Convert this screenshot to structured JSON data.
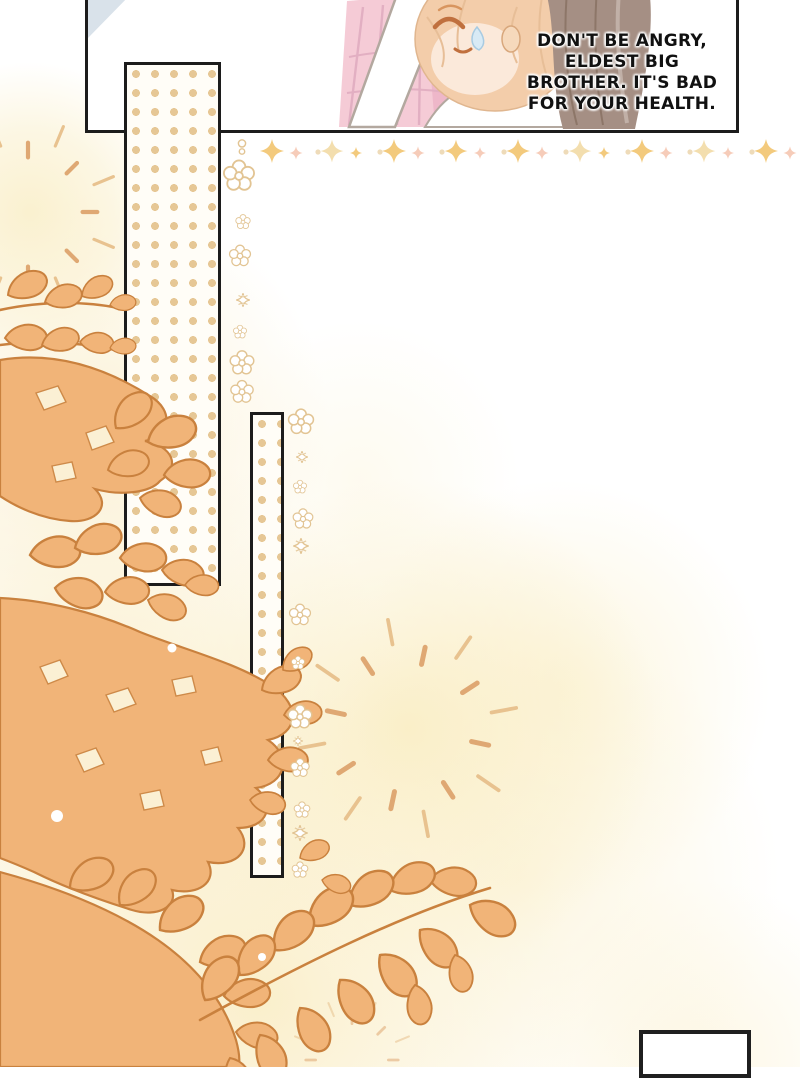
{
  "speech_bubble": {
    "lines": [
      "DON'T BE ANGRY,",
      "ELDEST BIG",
      "BROTHER. IT'S BAD",
      "FOR YOUR HEALTH."
    ]
  },
  "palette": {
    "panel_border": "#1c1c1c",
    "leaf_fill": "#F1B478",
    "leaf_outline": "#C9813E",
    "dot_tan": "#E6C795",
    "dot_orange": "#EFAC72",
    "sparkle_gold": "#F2C672",
    "sparkle_peach": "#F6C8B4",
    "glow_cream": "#FAF0CC",
    "skirt_pink": "#F5CBD6",
    "hair_peach": "#F3CDAA",
    "hair_brown": "#A58F84",
    "sweat_blue": "#D8EAF5"
  }
}
